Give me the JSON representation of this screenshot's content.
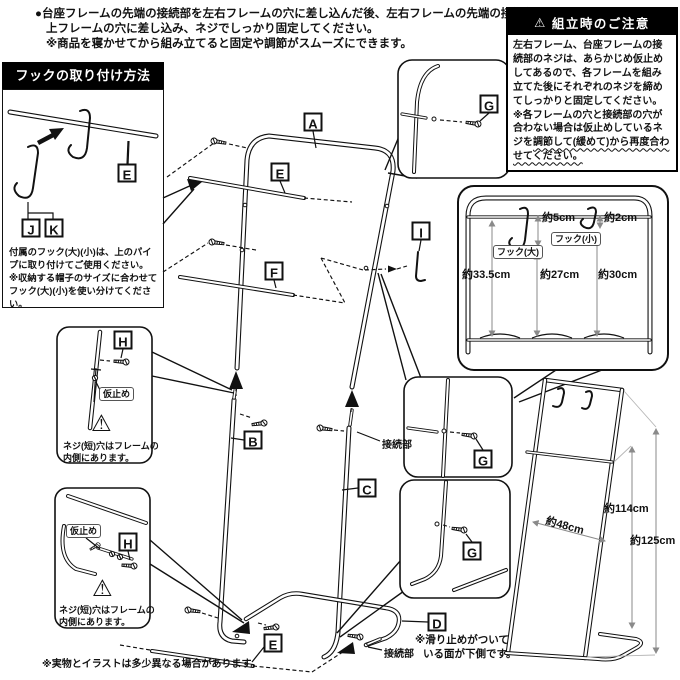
{
  "top_note": {
    "line1": "●台座フレームの先端の接続部を左右フレームの穴に差し込んだ後、左右フレームの先端の接続部を",
    "line2": "上フレームの穴に差し込み、ネジでしっかり固定してください。",
    "line3": "※商品を寝かせてから組み立てると固定や調節がスムーズにできます。"
  },
  "caution": {
    "icon": "⚠",
    "title": "組立時のご注意",
    "body1": "左右フレーム、台座フレームの接続部のネジは、あらかじめ仮止めしてあるので、各フレームを組み立てた後にそれぞれのネジを締めてしっかりと固定してください。",
    "body2_head": "※各フレームの穴と接続部の穴が合わない場合は仮止めしているネジを",
    "body2_wavy": "調節して(緩めて)から再度合わせてください。"
  },
  "hook_method": {
    "title": "フックの取り付け方法",
    "note1": "付属のフック(大)(小)は、上のパイプに取り付けてご使用ください。",
    "note2": "※収納する帽子のサイズに合わせてフック(大)(小)を使い分けてください。"
  },
  "parts": {
    "a": "A",
    "b": "B",
    "c": "C",
    "d": "D",
    "e": "E",
    "f": "F",
    "g": "G",
    "h": "H",
    "i": "I",
    "j": "J",
    "k": "K"
  },
  "annotations": {
    "connector": "接続部",
    "temp_fix": "仮止め",
    "warning_icon": "⚠",
    "screw_note_1": "ネジ(短)穴はフレームの",
    "screw_note_2": "内側にあります。",
    "anti_slip_1": "※滑り止めがついて",
    "anti_slip_2": "いる面が下側です。"
  },
  "dims_inset": {
    "hook_large": "フック(大)",
    "hook_small": "フック(小)",
    "hook_large_drop": "約5cm",
    "hook_small_drop": "約2cm",
    "left_height": "約33.5cm",
    "center_height": "約27cm",
    "right_height": "約30cm"
  },
  "product": {
    "width": "約48cm",
    "frame_height": "約114cm",
    "total_height": "約125cm"
  },
  "footer_note": "※実物とイラストは多少異なる場合があります。"
}
